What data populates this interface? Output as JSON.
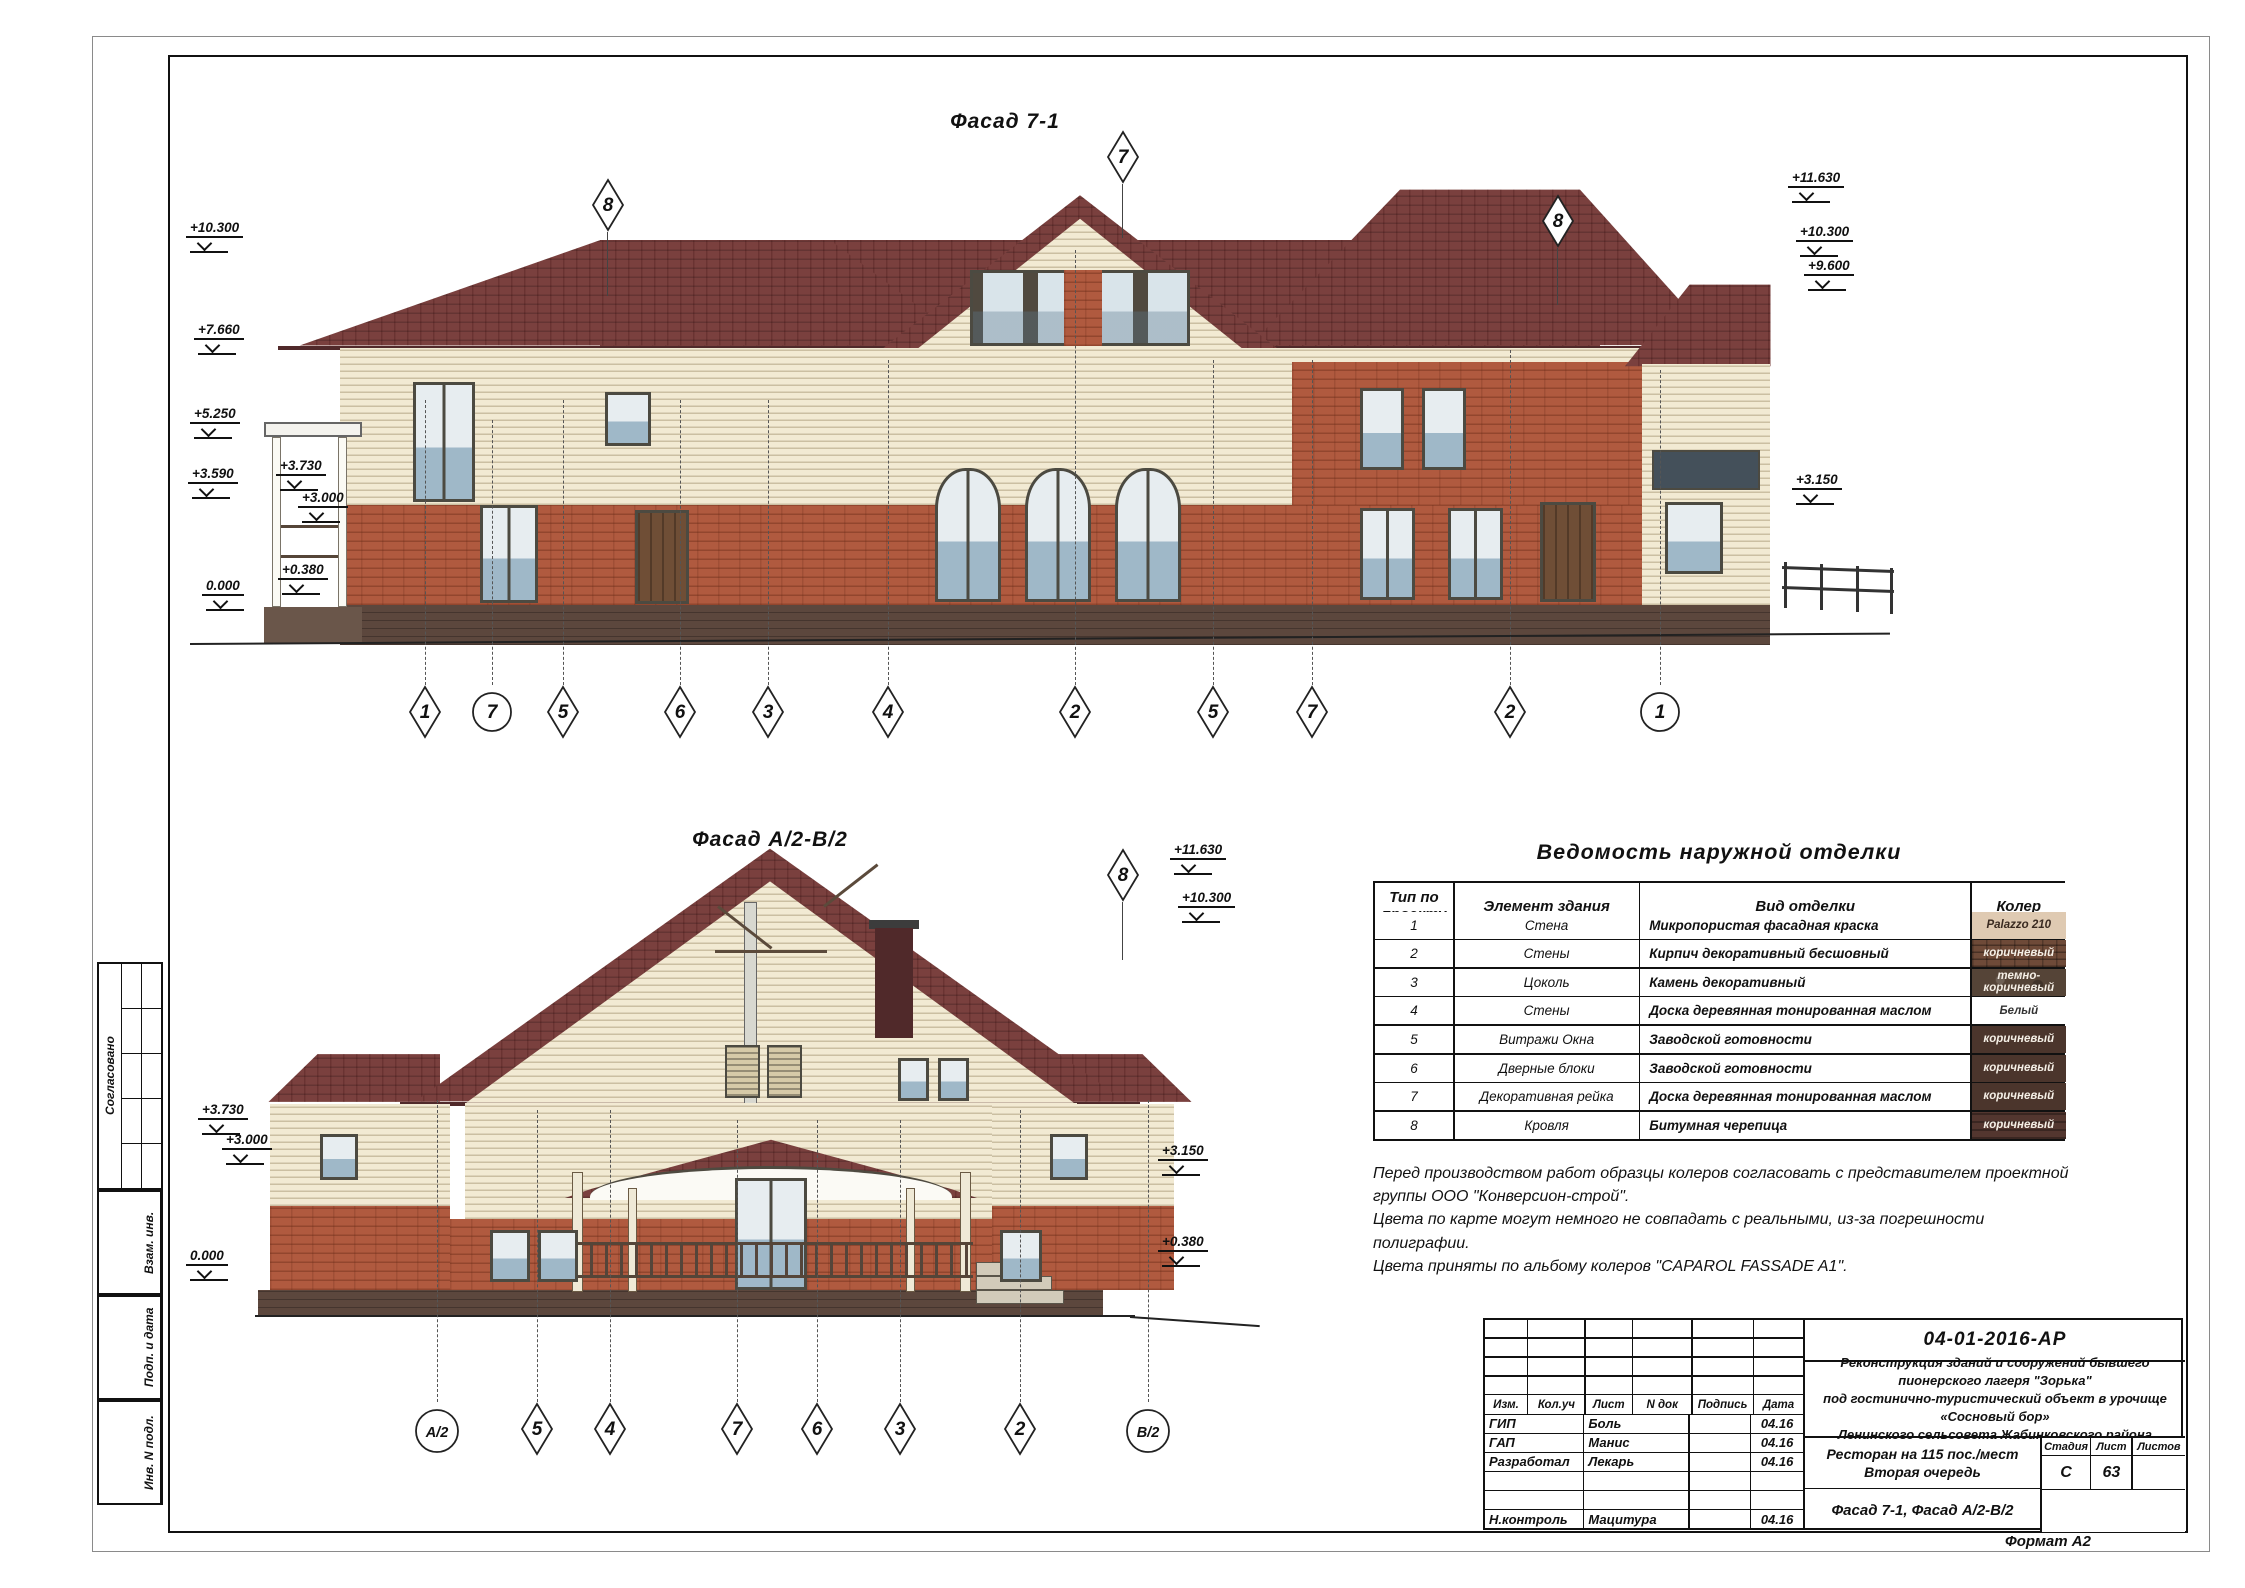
{
  "sheet": {
    "format_label": "Формат А2",
    "side_strip": {
      "labels": [
        "Согласовано",
        "Взам. инв.",
        "Подп. и дата",
        "Инв. N подл."
      ]
    }
  },
  "facade1": {
    "title": "Фасад 7-1",
    "top_axes": [
      {
        "label": "8"
      },
      {
        "label": "7"
      },
      {
        "label": "8"
      }
    ],
    "bottom_axes": [
      {
        "label": "1",
        "type": "diamond"
      },
      {
        "label": "7",
        "type": "circle"
      },
      {
        "label": "5",
        "type": "diamond"
      },
      {
        "label": "6",
        "type": "diamond"
      },
      {
        "label": "3",
        "type": "diamond"
      },
      {
        "label": "4",
        "type": "diamond"
      },
      {
        "label": "2",
        "type": "diamond"
      },
      {
        "label": "5",
        "type": "diamond"
      },
      {
        "label": "7",
        "type": "diamond"
      },
      {
        "label": "2",
        "type": "diamond"
      },
      {
        "label": "1",
        "type": "circle"
      }
    ],
    "left_elevations": [
      "+10.300",
      "+7.660",
      "+5.250",
      "+3.590",
      "+3.730",
      "+3.000",
      "0.000",
      "+0.380"
    ],
    "right_elevations": [
      "+11.630",
      "+10.300",
      "+9.600",
      "+3.150"
    ]
  },
  "facade2": {
    "title": "Фасад А/2-В/2",
    "top_axes": [
      {
        "label": "8"
      }
    ],
    "bottom_axes": [
      {
        "label": "А/2",
        "type": "circle"
      },
      {
        "label": "5",
        "type": "diamond"
      },
      {
        "label": "4",
        "type": "diamond"
      },
      {
        "label": "7",
        "type": "diamond"
      },
      {
        "label": "6",
        "type": "diamond"
      },
      {
        "label": "3",
        "type": "diamond"
      },
      {
        "label": "2",
        "type": "diamond"
      },
      {
        "label": "В/2",
        "type": "circle"
      }
    ],
    "left_elevations": [
      "+3.730",
      "+3.000",
      "0.000"
    ],
    "right_elevations": [
      "+11.630",
      "+10.300",
      "+3.150",
      "+0.380"
    ]
  },
  "finish_table": {
    "title": "Ведомость наружной отделки",
    "headers": [
      "Тип по проекту",
      "Элемент здания",
      "Вид отделки",
      "Колер"
    ],
    "rows": [
      {
        "num": "1",
        "element": "Стена",
        "finish": "Микропористая фасадная краска",
        "color_label": "Palazzo 210",
        "swatch": "#dfcab2",
        "label_color": "#3a2a20"
      },
      {
        "num": "2",
        "element": "Стены",
        "finish": "Кирпич декоративный бесшовный",
        "color_label": "коричневый",
        "swatch": "#6e4a38",
        "label_color": "#f5efe6"
      },
      {
        "num": "3",
        "element": "Цоколь",
        "finish": "Камень декоративный",
        "color_label": "темно-коричневый",
        "swatch": "#554437",
        "label_color": "#f5efe6"
      },
      {
        "num": "4",
        "element": "Стены",
        "finish": "Доска деревянная тонированная маслом",
        "color_label": "Белый",
        "swatch": "#ffffff",
        "label_color": "#333333"
      },
      {
        "num": "5",
        "element": "Витражи   Окна",
        "finish": "Заводской готовности",
        "color_label": "коричневый",
        "swatch": "#4b352c",
        "label_color": "#f5efe6"
      },
      {
        "num": "6",
        "element": "Дверные блоки",
        "finish": "Заводской готовности",
        "color_label": "коричневый",
        "swatch": "#4b352c",
        "label_color": "#f5efe6"
      },
      {
        "num": "7",
        "element": "Декоративная рейка",
        "finish": "Доска деревянная тонированная маслом",
        "color_label": "коричневый",
        "swatch": "#4b352c",
        "label_color": "#f5efe6"
      },
      {
        "num": "8",
        "element": "Кровля",
        "finish": "Битумная черепица",
        "color_label": "коричневый",
        "swatch": "#53362f",
        "label_color": "#f5efe6"
      }
    ]
  },
  "notes": {
    "lines": [
      "Перед производством работ образцы колеров согласовать с представителем проектной",
      "группы ООО \"Конверсион-строй\".",
      "Цвета по карте могут немного не совпадать с реальными, из-за погрешности полиграфии.",
      "Цвета приняты по альбому колеров  \"CAPAROL FASSADE A1\"."
    ]
  },
  "title_block": {
    "doc_number": "04-01-2016-АР",
    "project_lines": [
      "Реконструкция зданий и сооружений бывшего пионерского лагеря \"Зорька\"",
      "под  гостинично-туристический объект в урочище «Сосновый бор»",
      "Ленинского сельсовета Жабинковского района"
    ],
    "columns": [
      "Изм.",
      "Кол.уч",
      "Лист",
      "N док",
      "Подпись",
      "Дата"
    ],
    "rows": [
      {
        "role": "ГИП",
        "name": "Боль",
        "date": "04.16"
      },
      {
        "role": "ГАП",
        "name": "Манис",
        "date": "04.16"
      },
      {
        "role": "Разработал",
        "name": "Лекарь",
        "date": "04.16"
      },
      {
        "role": "",
        "name": "",
        "date": ""
      },
      {
        "role": "",
        "name": "",
        "date": ""
      },
      {
        "role": "Н.контроль",
        "name": "Мацитура",
        "date": "04.16"
      }
    ],
    "object_lines": [
      "Ресторан на 115 пос./мест",
      "Вторая очередь"
    ],
    "sheet_title": "Фасад 7-1, Фасад А/2-В/2",
    "stage_header": [
      "Стадия",
      "Лист",
      "Листов"
    ],
    "stage": "С",
    "sheet_num": "63",
    "sheets_total": ""
  },
  "colors": {
    "roof": "#7a403e",
    "roof_edge": "#50292a",
    "siding": "#f2ead3",
    "brick": "#b05a3f",
    "plinth": "#5c473d",
    "frame": "#4c4a41",
    "glass_top": "#e7edf0",
    "glass_bottom": "#9fb8c8"
  }
}
